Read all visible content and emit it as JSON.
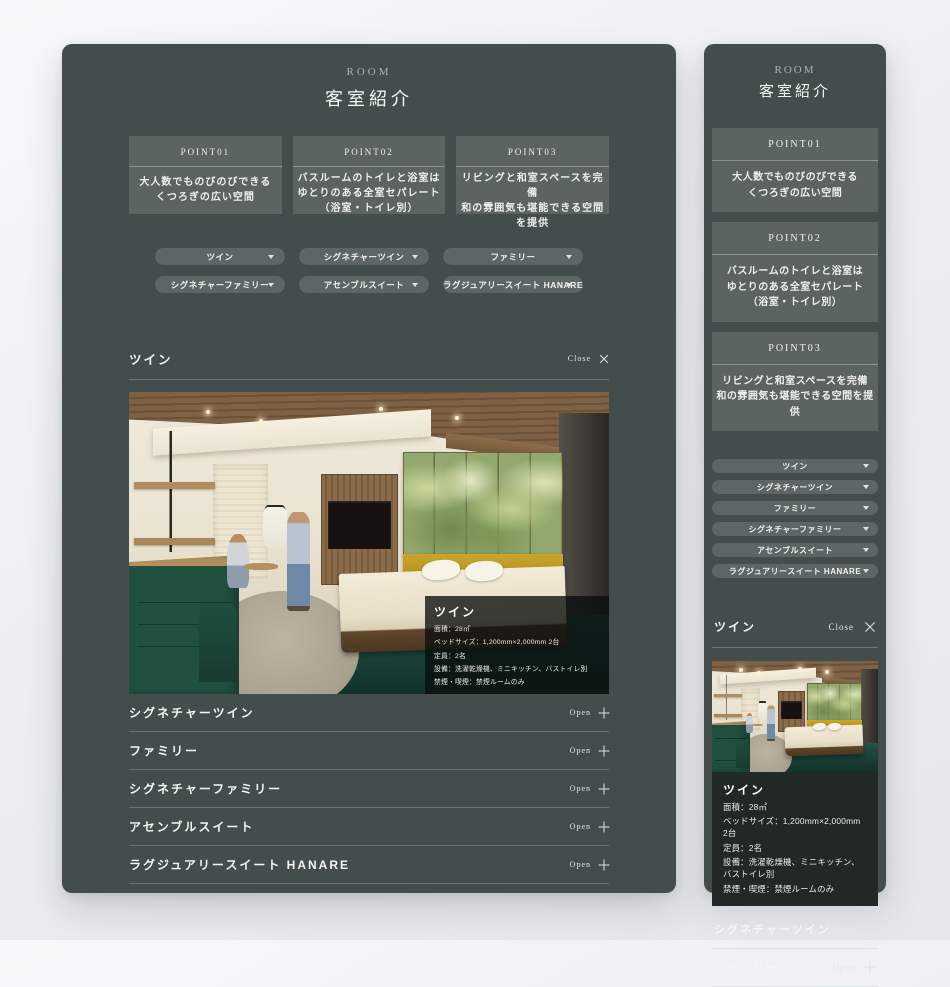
{
  "header": {
    "label": "ROOM",
    "title": "客室紹介"
  },
  "points": [
    {
      "label": "POINT01",
      "lines": [
        "大人数でものびのびできる",
        "くつろぎの広い空間"
      ]
    },
    {
      "label": "POINT02",
      "lines": [
        "バスルームのトイレと浴室は",
        "ゆとりのある全室セパレート",
        "（浴室・トイレ別）"
      ]
    },
    {
      "label": "POINT03",
      "lines": [
        "リビングと和室スペースを完備",
        "和の雰囲気も堪能できる空間を提供"
      ]
    }
  ],
  "rooms": [
    "ツイン",
    "シグネチャーツイン",
    "ファミリー",
    "シグネチャーファミリー",
    "アセンブルスイート",
    "ラグジュアリースイート HANARE"
  ],
  "accordion": {
    "open_label": "Open",
    "close_label": "Close"
  },
  "active_room": {
    "name": "ツイン",
    "specs": [
      "面積：28㎡",
      "ベッドサイズ：1,200mm×2,000mm 2台",
      "定員：2名",
      "設備：洗濯乾燥機、ミニキッチン、バストイレ別",
      "禁煙・喫煙：禁煙ルームのみ"
    ]
  },
  "colors": {
    "panel_background": "#434e4c",
    "point_box": "#5c6462",
    "pill_button": "#5d6664",
    "info_overlay": "rgba(10,14,13,0.78)",
    "mobile_info_box": "#212826",
    "art_green": "#93a86e",
    "headboard_yellow": "#cba52c",
    "carpet_teal": "#1a453c",
    "cabinet_green": "#215041"
  }
}
